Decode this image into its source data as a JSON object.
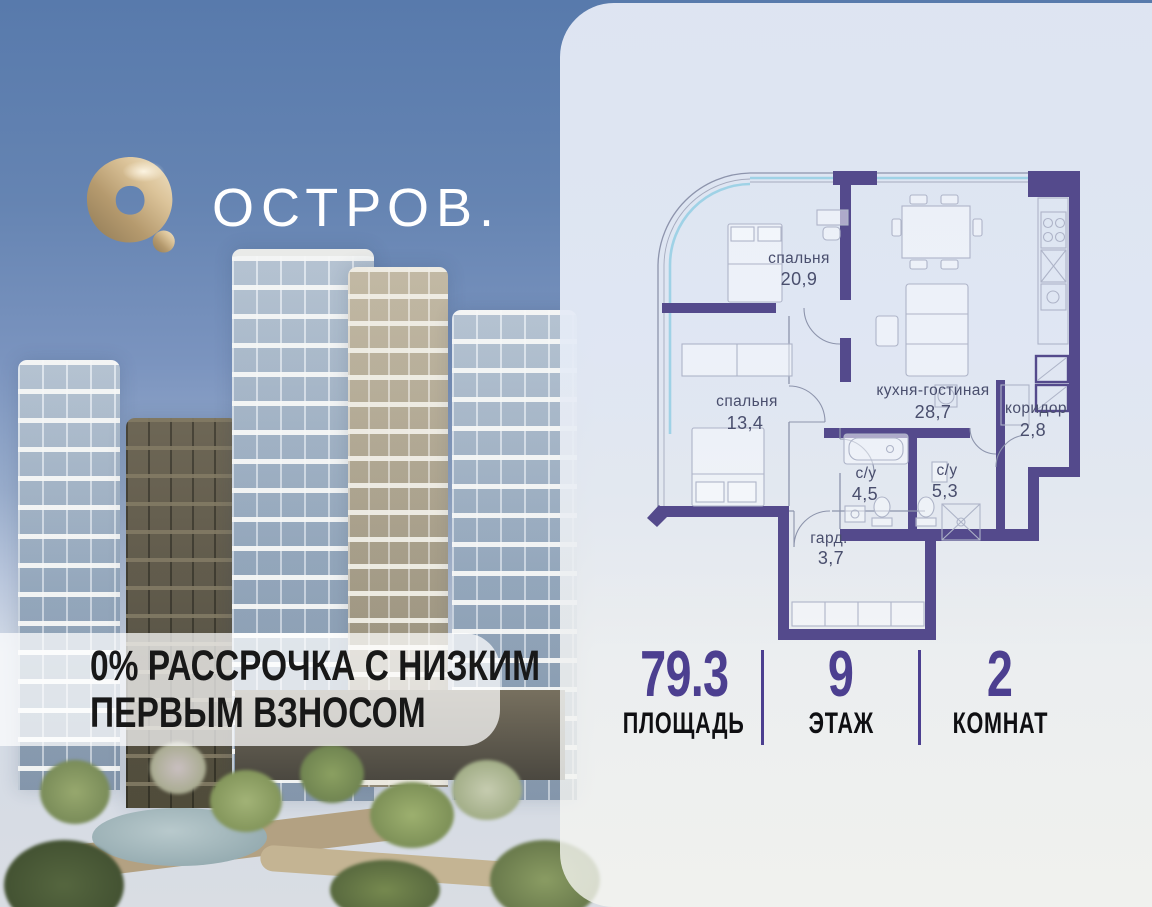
{
  "brand": {
    "name": "ОСТРОВ."
  },
  "promo": {
    "line1": "0% РАССРОЧКА С НИЗКИМ",
    "line2": "ПЕРВЫМ ВЗНОСОМ"
  },
  "floorplan": {
    "rooms": [
      {
        "name": "спальня",
        "area": "20,9"
      },
      {
        "name": "кухня-гостиная",
        "area": "28,7"
      },
      {
        "name": "коридор",
        "area": "2,8"
      },
      {
        "name": "спальня",
        "area": "13,4"
      },
      {
        "name": "с/у",
        "area": "4,5"
      },
      {
        "name": "с/у",
        "area": "5,3"
      },
      {
        "name": "гард.",
        "area": "3,7"
      }
    ]
  },
  "stats": {
    "area": {
      "value": "79.3",
      "label": "ПЛОЩАДЬ"
    },
    "floor": {
      "value": "9",
      "label": "ЭТАЖ"
    },
    "rooms": {
      "value": "2",
      "label": "КОМНАТ"
    }
  },
  "colors": {
    "accent_purple": "#4c3f90",
    "wall_purple": "#544a8c",
    "gold": "#c9ad80",
    "window_blue": "#9fd2e6"
  }
}
